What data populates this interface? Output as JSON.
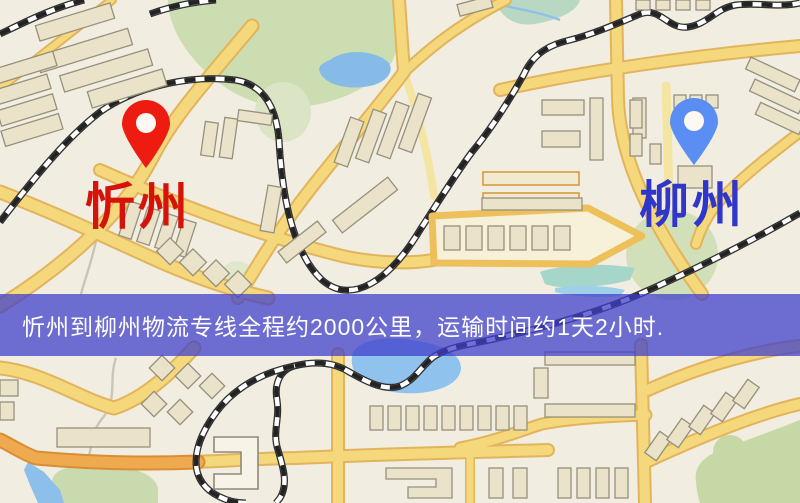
{
  "map": {
    "origin": {
      "label": "忻州"
    },
    "destination": {
      "label": "柳州"
    }
  },
  "banner": {
    "text": "忻州到柳州物流专线全程约2000公里，运输时间约1天2小时."
  },
  "colors": {
    "origin_pin": "#ed1b10",
    "origin_label": "#d6130a",
    "dest_pin": "#5b8ef3",
    "dest_label": "#2f36c9",
    "banner_bg": "rgba(62,62,202,0.74)",
    "banner_text": "#ffffff"
  }
}
